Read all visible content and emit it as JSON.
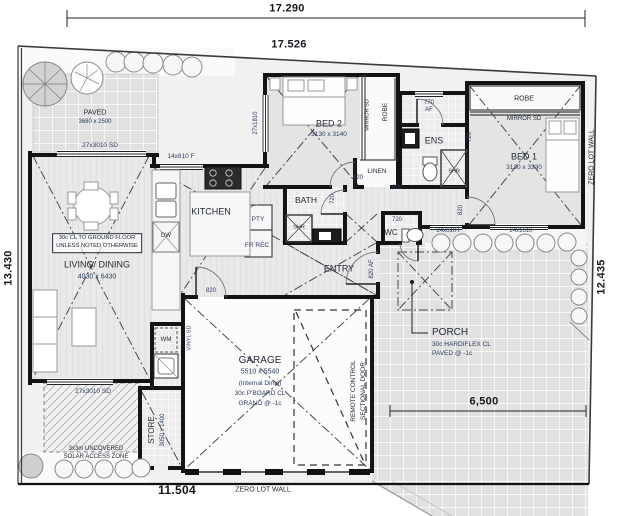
{
  "dimensions": {
    "top_outer": "17.290",
    "top_inner": "17.526",
    "left_side": "13.430",
    "right_side": "12.435",
    "bottom": "11.504",
    "yard_width": "6,500"
  },
  "boundary_notes": {
    "zero_lot_bottom": "ZERO LOT WALL",
    "zero_lot_right": "ZERO LOT WALL"
  },
  "rooms": {
    "living": {
      "name": "LIVING/ DINING",
      "size": "4030 x 6430"
    },
    "kitchen": {
      "name": "KITCHEN"
    },
    "bed1": {
      "name": "BED 1",
      "size": "3130 x 3330"
    },
    "bed2": {
      "name": "BED 2",
      "size": "3130 x 3140"
    },
    "bath": {
      "name": "BATH"
    },
    "ens": {
      "name": "ENS"
    },
    "wc": {
      "name": "WC"
    },
    "entry": {
      "name": "ENTRY"
    },
    "porch": {
      "name": "PORCH",
      "ceiling": "30c HARDIFLEX CL",
      "finish": "PAVED @ -1c"
    },
    "garage": {
      "name": "GARAGE",
      "size": "5510 x 5540",
      "note": "(Internal Dims)",
      "ceiling": "30c P'BOARD CL",
      "finish": "GRANO @ -1c"
    },
    "store": {
      "name": "STORE",
      "size": "3050 x 1400"
    },
    "courtyard": {
      "name": "PAVED",
      "size": "3680 x 2500"
    }
  },
  "fixtures": {
    "pantry": "PTY",
    "fridge_recess": "FR REC",
    "dishwasher": "DW",
    "washing_machine": "WM",
    "linen": "LINEN",
    "robe_bed2": "ROBE",
    "mirror_bed2": "MIRROR SD",
    "robe_bed1": "ROBE",
    "mirror_bed1": "MIRROR SD",
    "shower_ens": "SHR",
    "shower_bath": "SHR"
  },
  "openings": {
    "living_top": "27x3010 SD",
    "kitchen_window": "14x810 F",
    "bed2_window": "27x1810",
    "living_bottom": "27x3010 SD",
    "wc_window": "24x610 F",
    "bed1_window": "24x1610",
    "ens_window": "770",
    "ens_window_type": "AF",
    "laundry_slider": "VINYL SD",
    "garage_door_line1": "REMOTE CONTROL",
    "garage_door_line2": "SECTIONAL DOOR",
    "entry_door": "820 AF",
    "doors_820": [
      "820",
      "820",
      "820",
      "820"
    ],
    "doors_720": [
      "720",
      "720",
      "720"
    ]
  },
  "notes": {
    "ceiling_line1": "30c CL TO GROUND FLOOR",
    "ceiling_line2": "UNLESS NOTED OTHERWISE",
    "solar_line1": "3x3m UNCOVERED",
    "solar_line2": "SOLAR ACCESS ZONE"
  }
}
